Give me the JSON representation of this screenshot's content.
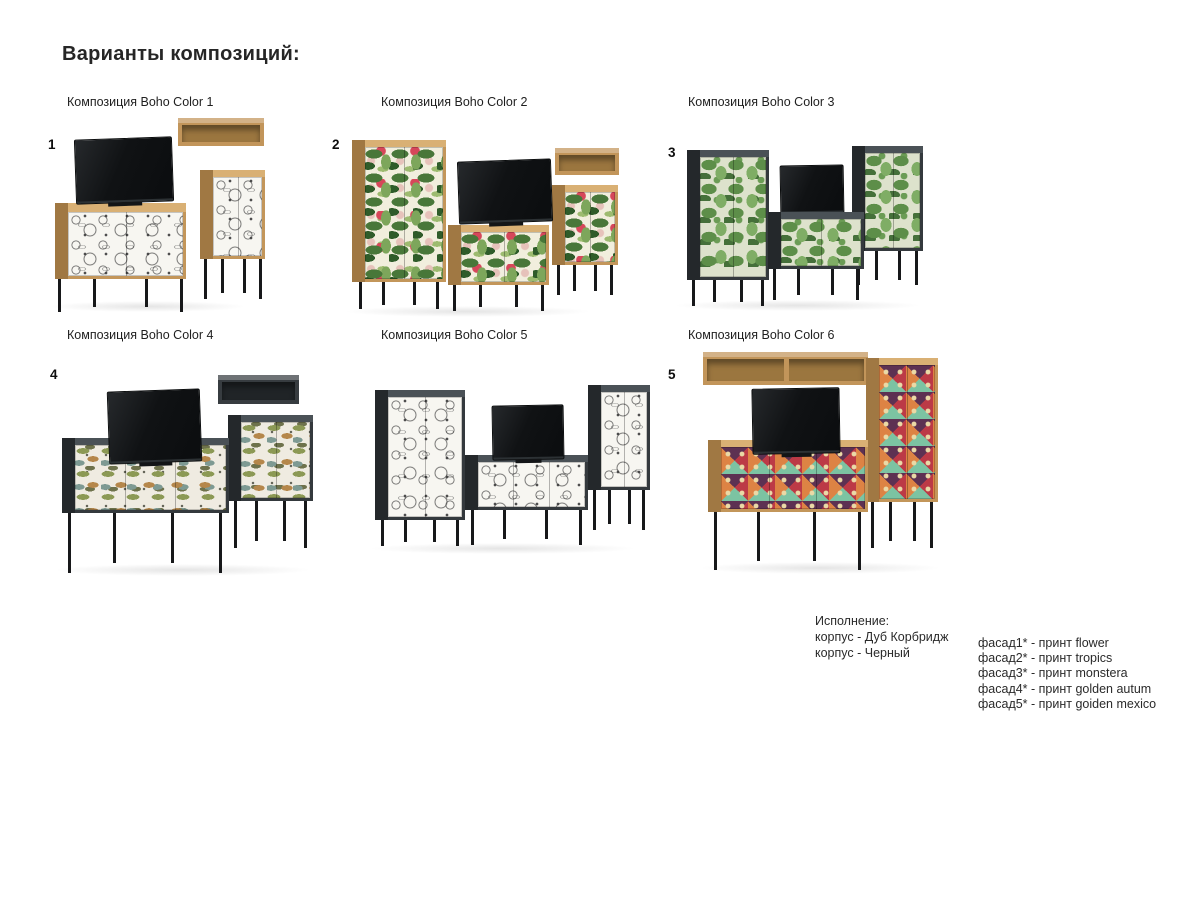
{
  "page": {
    "title": "Варианты композиций:"
  },
  "compositions": [
    {
      "number": "1",
      "label": "Композиция Boho Color 1",
      "facade_print": "flower",
      "corpus_style": "oak"
    },
    {
      "number": "2",
      "label": "Композиция Boho Color 2",
      "facade_print": "tropics",
      "corpus_style": "oak"
    },
    {
      "number": "3",
      "label": "Композиция Boho Color 3",
      "facade_print": "monstera",
      "corpus_style": "black"
    },
    {
      "number": "4",
      "label": "Композиция Boho Color 4",
      "facade_print": "golden autum",
      "corpus_style": "black"
    },
    {
      "label": "Композиция Boho Color 5",
      "facade_print": "flower",
      "corpus_style": "black"
    },
    {
      "number": "5",
      "label": "Композиция Boho Color 6",
      "facade_print": "goiden mexico",
      "corpus_style": "oak"
    }
  ],
  "legend": {
    "title": "Исполнение:",
    "corpus_options": [
      "корпус - Дуб Корбридж",
      "корпус - Черный"
    ],
    "facade_options": [
      "фасад1* - принт flower",
      "фасад2* - принт tropics",
      "фасад3* - принт monstera",
      "фасад4* - принт golden autum",
      "фасад5* - принт goiden mexico"
    ]
  },
  "colors": {
    "oak": "#c3965a",
    "graphite": "#34393d",
    "leg_black": "#17181a",
    "tv_black": "#101214",
    "flower_bg": "#f7f6f1",
    "tropics_green": "#487739",
    "tropics_red": "#d6475a",
    "monstera_bg": "#dde2cc",
    "monstera_green": "#5d8e49",
    "autumn_bg": "#efebe1",
    "mexico_red": "#bc3a46",
    "mexico_teal": "#7cc3a2",
    "mexico_orange": "#dd8344"
  }
}
